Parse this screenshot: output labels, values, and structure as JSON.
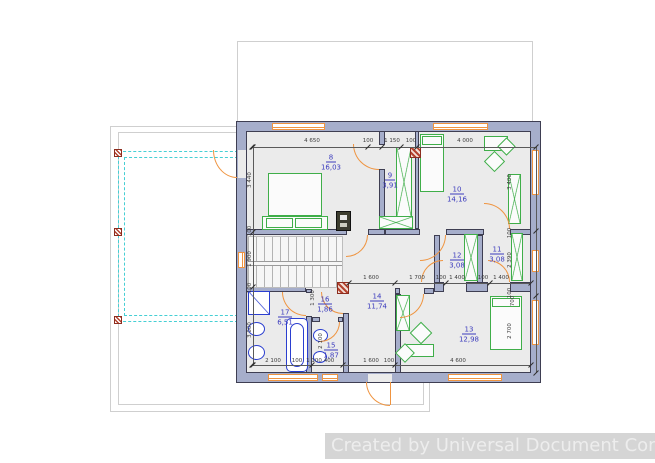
{
  "watermark": {
    "text": "Created by Universal Document Converter"
  },
  "colors": {
    "wall": "#a6aecb",
    "edge": "#3e3e52",
    "floor": "#ebebeb",
    "furniture_green": "#3fae49",
    "plumbing_blue": "#2b3fd0",
    "opening_orange": "#ef9440",
    "terrace_cyan": "#45cfd4",
    "room_label_blue": "#3b3bbd"
  },
  "rooms": [
    {
      "number": "8",
      "area": "16,03",
      "cx": 331,
      "cy": 158
    },
    {
      "number": "9",
      "area": "3,91",
      "cx": 390,
      "cy": 176
    },
    {
      "number": "10",
      "area": "14,16",
      "cx": 457,
      "cy": 190
    },
    {
      "number": "11",
      "area": "3,08",
      "cx": 497,
      "cy": 250
    },
    {
      "number": "12",
      "area": "3,08",
      "cx": 457,
      "cy": 256
    },
    {
      "number": "13",
      "area": "12,98",
      "cx": 469,
      "cy": 330
    },
    {
      "number": "14",
      "area": "11,74",
      "cx": 377,
      "cy": 297
    },
    {
      "number": "15",
      "area": "1,87",
      "cx": 331,
      "cy": 346
    },
    {
      "number": "16",
      "area": "1,86",
      "cx": 325,
      "cy": 300
    },
    {
      "number": "17",
      "area": "6,51",
      "cx": 285,
      "cy": 313
    }
  ],
  "dimensions": [
    {
      "t": "4 650",
      "x": 312,
      "y": 141,
      "r": 0
    },
    {
      "t": "100",
      "x": 368,
      "y": 141,
      "r": 0
    },
    {
      "t": "1 150",
      "x": 392,
      "y": 141,
      "r": 0
    },
    {
      "t": "100",
      "x": 411,
      "y": 141,
      "r": 0
    },
    {
      "t": "4 000",
      "x": 465,
      "y": 141,
      "r": 0
    },
    {
      "t": "3 440",
      "x": 250,
      "y": 180,
      "r": 1
    },
    {
      "t": "100",
      "x": 250,
      "y": 231,
      "r": 1
    },
    {
      "t": "1 900",
      "x": 250,
      "y": 259,
      "r": 1
    },
    {
      "t": "100",
      "x": 250,
      "y": 288,
      "r": 1
    },
    {
      "t": "3 000",
      "x": 250,
      "y": 330,
      "r": 1
    },
    {
      "t": "3 400",
      "x": 510,
      "y": 182,
      "r": 1
    },
    {
      "t": "100",
      "x": 510,
      "y": 233,
      "r": 1
    },
    {
      "t": "2 390",
      "x": 510,
      "y": 260,
      "r": 1
    },
    {
      "t": "100",
      "x": 510,
      "y": 293,
      "r": 1
    },
    {
      "t": "700",
      "x": 513,
      "y": 301,
      "r": 1
    },
    {
      "t": "2 700",
      "x": 510,
      "y": 331,
      "r": 1
    },
    {
      "t": "1 600",
      "x": 371,
      "y": 278,
      "r": 0
    },
    {
      "t": "1 700",
      "x": 417,
      "y": 278,
      "r": 0
    },
    {
      "t": "100",
      "x": 441,
      "y": 278,
      "r": 0
    },
    {
      "t": "1 400",
      "x": 457,
      "y": 278,
      "r": 0
    },
    {
      "t": "100",
      "x": 483,
      "y": 278,
      "r": 0
    },
    {
      "t": "1 400",
      "x": 501,
      "y": 278,
      "r": 0
    },
    {
      "t": "2 100",
      "x": 273,
      "y": 361,
      "r": 0
    },
    {
      "t": "100",
      "x": 297,
      "y": 361,
      "r": 0
    },
    {
      "t": "1 100",
      "x": 314,
      "y": 361,
      "r": 0
    },
    {
      "t": "400",
      "x": 329,
      "y": 361,
      "r": 0
    },
    {
      "t": "1 600",
      "x": 371,
      "y": 361,
      "r": 0
    },
    {
      "t": "100",
      "x": 389,
      "y": 361,
      "r": 0
    },
    {
      "t": "4 600",
      "x": 458,
      "y": 361,
      "r": 0
    },
    {
      "t": "1 300",
      "x": 313,
      "y": 298,
      "r": 1
    },
    {
      "t": "2 100",
      "x": 321,
      "y": 341,
      "r": 1
    }
  ],
  "plan": {
    "outlines": [
      {
        "x": 110,
        "y": 126,
        "w": 320,
        "h": 286
      },
      {
        "x": 118,
        "y": 132,
        "w": 306,
        "h": 273
      },
      {
        "x": 237,
        "y": 41,
        "w": 296,
        "h": 81
      }
    ],
    "terrace": [
      {
        "x": 118,
        "y": 151,
        "w": 120,
        "h": 171
      },
      {
        "x": 124,
        "y": 157,
        "w": 114,
        "h": 159
      }
    ],
    "posts": [
      {
        "x": 114,
        "y": 149,
        "w": 8,
        "h": 8
      },
      {
        "x": 114,
        "y": 228,
        "w": 8,
        "h": 8
      },
      {
        "x": 114,
        "y": 316,
        "w": 8,
        "h": 8
      }
    ],
    "building": {
      "x": 237,
      "y": 122,
      "w": 303,
      "h": 260
    },
    "walls": [
      {
        "x": 379,
        "y": 131,
        "w": 6,
        "h": 14
      },
      {
        "x": 379,
        "y": 169,
        "w": 6,
        "h": 60
      },
      {
        "x": 415,
        "y": 131,
        "w": 4,
        "h": 98
      },
      {
        "x": 246,
        "y": 229,
        "w": 101,
        "h": 6
      },
      {
        "x": 368,
        "y": 229,
        "w": 17,
        "h": 6
      },
      {
        "x": 385,
        "y": 229,
        "w": 35,
        "h": 6
      },
      {
        "x": 446,
        "y": 229,
        "w": 38,
        "h": 6
      },
      {
        "x": 510,
        "y": 229,
        "w": 21,
        "h": 6
      },
      {
        "x": 434,
        "y": 235,
        "w": 6,
        "h": 53
      },
      {
        "x": 477,
        "y": 235,
        "w": 6,
        "h": 53
      },
      {
        "x": 434,
        "y": 282,
        "w": 10,
        "h": 10
      },
      {
        "x": 466,
        "y": 282,
        "w": 22,
        "h": 10
      },
      {
        "x": 510,
        "y": 282,
        "w": 21,
        "h": 10
      },
      {
        "x": 395,
        "y": 288,
        "w": 5,
        "h": 6
      },
      {
        "x": 424,
        "y": 288,
        "w": 10,
        "h": 6
      },
      {
        "x": 395,
        "y": 294,
        "w": 6,
        "h": 79
      },
      {
        "x": 343,
        "y": 289,
        "w": 6,
        "h": 4
      },
      {
        "x": 343,
        "y": 313,
        "w": 6,
        "h": 60
      },
      {
        "x": 246,
        "y": 286,
        "w": 60,
        "h": 6
      },
      {
        "x": 306,
        "y": 289,
        "w": 6,
        "h": 4
      },
      {
        "x": 306,
        "y": 316,
        "w": 6,
        "h": 57
      },
      {
        "x": 312,
        "y": 317,
        "w": 8,
        "h": 5
      },
      {
        "x": 338,
        "y": 317,
        "w": 5,
        "h": 5
      }
    ],
    "gaps": [
      {
        "x": 238,
        "y": 150,
        "w": 8,
        "h": 28
      },
      {
        "x": 368,
        "y": 374,
        "w": 24,
        "h": 8
      }
    ],
    "windows": [
      {
        "x": 272,
        "y": 123,
        "w": 53,
        "h": 7
      },
      {
        "x": 433,
        "y": 123,
        "w": 55,
        "h": 7
      },
      {
        "x": 238,
        "y": 252,
        "w": 7,
        "h": 16
      },
      {
        "x": 532,
        "y": 150,
        "w": 7,
        "h": 45
      },
      {
        "x": 532,
        "y": 250,
        "w": 7,
        "h": 22
      },
      {
        "x": 532,
        "y": 300,
        "w": 7,
        "h": 45
      },
      {
        "x": 268,
        "y": 374,
        "w": 50,
        "h": 7
      },
      {
        "x": 322,
        "y": 374,
        "w": 16,
        "h": 7
      },
      {
        "x": 448,
        "y": 374,
        "w": 54,
        "h": 7
      }
    ],
    "stairs": {
      "x": 247,
      "y": 236,
      "w": 96,
      "h": 52
    },
    "furniture": [
      {
        "x": 268,
        "y": 173,
        "w": 54,
        "h": 43,
        "t": "g",
        "n": "bed"
      },
      {
        "x": 262,
        "y": 216,
        "w": 66,
        "h": 14,
        "t": "g",
        "n": "bed-base"
      },
      {
        "x": 266,
        "y": 218,
        "w": 27,
        "h": 10,
        "t": "g",
        "n": "pillow"
      },
      {
        "x": 295,
        "y": 218,
        "w": 27,
        "h": 10,
        "t": "g",
        "n": "pillow"
      },
      {
        "x": 396,
        "y": 147,
        "w": 16,
        "h": 70,
        "t": "gx",
        "n": "wardrobe"
      },
      {
        "x": 379,
        "y": 216,
        "w": 34,
        "h": 13,
        "t": "gx",
        "n": "wardrobe"
      },
      {
        "x": 420,
        "y": 134,
        "w": 24,
        "h": 58,
        "t": "g",
        "n": "bed"
      },
      {
        "x": 422,
        "y": 136,
        "w": 20,
        "h": 9,
        "t": "g",
        "n": "pillow"
      },
      {
        "x": 508,
        "y": 174,
        "w": 13,
        "h": 50,
        "t": "gx",
        "n": "wardrobe"
      },
      {
        "x": 484,
        "y": 136,
        "w": 24,
        "h": 15,
        "t": "g",
        "n": "desk"
      },
      {
        "x": 487,
        "y": 154,
        "w": 15,
        "h": 15,
        "t": "gd",
        "n": "chair"
      },
      {
        "x": 500,
        "y": 140,
        "w": 13,
        "h": 13,
        "t": "gd",
        "n": "plant"
      },
      {
        "x": 511,
        "y": 233,
        "w": 12,
        "h": 48,
        "t": "gx",
        "n": "wardrobe"
      },
      {
        "x": 464,
        "y": 234,
        "w": 14,
        "h": 47,
        "t": "gx",
        "n": "wardrobe"
      },
      {
        "x": 396,
        "y": 295,
        "w": 14,
        "h": 36,
        "t": "gx",
        "n": "wardrobe"
      },
      {
        "x": 490,
        "y": 296,
        "w": 32,
        "h": 54,
        "t": "g",
        "n": "bed"
      },
      {
        "x": 492,
        "y": 298,
        "w": 28,
        "h": 9,
        "t": "g",
        "n": "pillow"
      },
      {
        "x": 404,
        "y": 344,
        "w": 30,
        "h": 13,
        "t": "g",
        "n": "desk"
      },
      {
        "x": 413,
        "y": 325,
        "w": 16,
        "h": 16,
        "t": "gd",
        "n": "chair"
      },
      {
        "x": 398,
        "y": 346,
        "w": 14,
        "h": 14,
        "t": "gd",
        "n": "stool"
      },
      {
        "x": 248,
        "y": 291,
        "w": 22,
        "h": 24,
        "t": "shower",
        "n": "shower"
      },
      {
        "x": 248,
        "y": 322,
        "w": 17,
        "h": 14,
        "t": "wc",
        "n": "toilet"
      },
      {
        "x": 248,
        "y": 345,
        "w": 17,
        "h": 15,
        "t": "wc",
        "n": "bidet"
      },
      {
        "x": 286,
        "y": 318,
        "w": 22,
        "h": 54,
        "t": "tub",
        "n": "bathtub"
      },
      {
        "x": 313,
        "y": 329,
        "w": 15,
        "h": 13,
        "t": "wc",
        "n": "toilet"
      },
      {
        "x": 313,
        "y": 351,
        "w": 14,
        "h": 12,
        "t": "wc",
        "n": "sink"
      },
      {
        "x": 336,
        "y": 211,
        "w": 15,
        "h": 20,
        "t": "chimney",
        "n": "chimney-shaft"
      },
      {
        "x": 337,
        "y": 282,
        "w": 12,
        "h": 12,
        "t": "col",
        "n": "column"
      },
      {
        "x": 410,
        "y": 147,
        "w": 11,
        "h": 11,
        "t": "col",
        "n": "column"
      }
    ],
    "arcs": [
      {
        "x": 353,
        "y": 144,
        "w": 26,
        "h": 26,
        "c": "bl"
      },
      {
        "x": 346,
        "y": 235,
        "w": 22,
        "h": 22,
        "c": "br"
      },
      {
        "x": 420,
        "y": 235,
        "w": 26,
        "h": 26,
        "c": "br"
      },
      {
        "x": 484,
        "y": 203,
        "w": 26,
        "h": 26,
        "c": "tr"
      },
      {
        "x": 421,
        "y": 260,
        "w": 22,
        "h": 22,
        "c": "tl"
      },
      {
        "x": 488,
        "y": 260,
        "w": 22,
        "h": 22,
        "c": "tr"
      },
      {
        "x": 400,
        "y": 294,
        "w": 24,
        "h": 24,
        "c": "br"
      },
      {
        "x": 282,
        "y": 292,
        "w": 24,
        "h": 24,
        "c": "bl"
      },
      {
        "x": 321,
        "y": 292,
        "w": 22,
        "h": 22,
        "c": "bl"
      },
      {
        "x": 320,
        "y": 322,
        "w": 20,
        "h": 20,
        "c": "br"
      },
      {
        "x": 366,
        "y": 382,
        "w": 24,
        "h": 24,
        "c": "bl"
      },
      {
        "x": 213,
        "y": 150,
        "w": 24,
        "h": 28,
        "c": "bl"
      }
    ],
    "leafs": [
      {
        "x": 390,
        "y": 382,
        "w": 1,
        "h": 23
      }
    ],
    "dlines": [
      {
        "x": 252,
        "y": 147,
        "w": 284,
        "h": 1
      },
      {
        "x": 349,
        "y": 283,
        "w": 182,
        "h": 1
      },
      {
        "x": 252,
        "y": 365,
        "w": 279,
        "h": 1
      },
      {
        "x": 253,
        "y": 147,
        "w": 1,
        "h": 218
      },
      {
        "x": 536,
        "y": 147,
        "w": 1,
        "h": 226
      }
    ],
    "ticks": [
      {
        "x": 252,
        "y": 147
      },
      {
        "x": 368,
        "y": 147
      },
      {
        "x": 382,
        "y": 147
      },
      {
        "x": 401,
        "y": 147
      },
      {
        "x": 417,
        "y": 147
      },
      {
        "x": 536,
        "y": 147
      },
      {
        "x": 253,
        "y": 147
      },
      {
        "x": 253,
        "y": 232
      },
      {
        "x": 253,
        "y": 287
      },
      {
        "x": 253,
        "y": 365
      },
      {
        "x": 536,
        "y": 231
      },
      {
        "x": 536,
        "y": 296
      },
      {
        "x": 536,
        "y": 373
      },
      {
        "x": 349,
        "y": 283
      },
      {
        "x": 395,
        "y": 283
      },
      {
        "x": 446,
        "y": 283
      },
      {
        "x": 490,
        "y": 283
      },
      {
        "x": 531,
        "y": 283
      },
      {
        "x": 252,
        "y": 365
      },
      {
        "x": 312,
        "y": 365
      },
      {
        "x": 343,
        "y": 365
      },
      {
        "x": 395,
        "y": 365
      },
      {
        "x": 531,
        "y": 365
      }
    ]
  }
}
